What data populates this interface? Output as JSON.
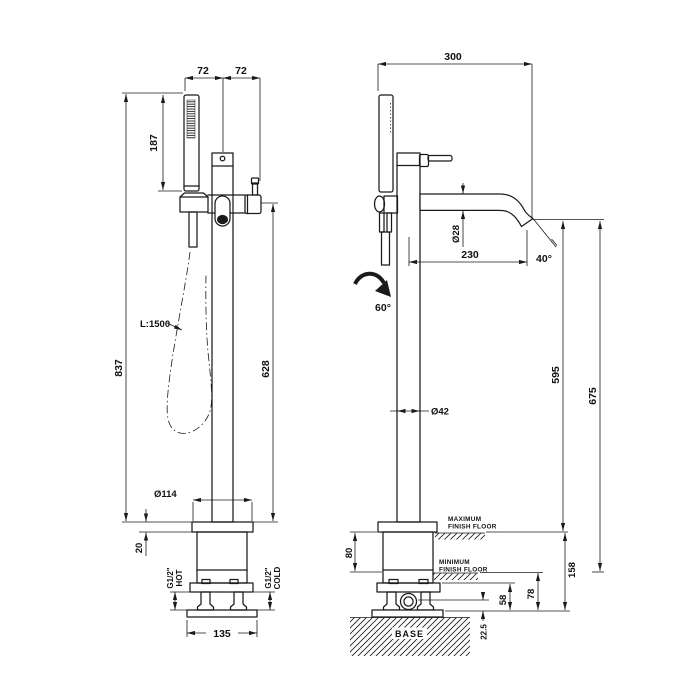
{
  "drawing": {
    "background": "#ffffff",
    "ink": "#1a1a1a",
    "front_view": {
      "dims": {
        "width_left": "72",
        "width_right": "72",
        "handshower_height": "187",
        "total_height": "837",
        "hose_length": "L:1500",
        "outlet_height": "628",
        "plate_diameter": "Ø114",
        "plate_thickness": "20",
        "hot_size": "G1/2\"",
        "hot_label": "HOT",
        "cold_size": "G1/2\"",
        "cold_label": "COLD",
        "base_width": "135"
      }
    },
    "side_view": {
      "dims": {
        "depth": "300",
        "spout_diameter": "Ø28",
        "spout_reach": "230",
        "spout_end_angle": "40°",
        "swivel_angle": "60°",
        "column_diameter": "Ø42",
        "spout_height_max_floor": "595",
        "spout_height_min_floor": "675",
        "max_floor_word": "MAXIMUM",
        "max_floor_words2": "FINISH FLOOR",
        "floor_adjust_range": "80",
        "min_floor_word": "MINIMUM",
        "min_floor_words2": "FINISH FLOOR",
        "max_floor_to_base": "158",
        "min_floor_to_base": "78",
        "flange_to_base": "58",
        "inlet_to_base": "22.5",
        "base_label": "BASE"
      }
    }
  }
}
